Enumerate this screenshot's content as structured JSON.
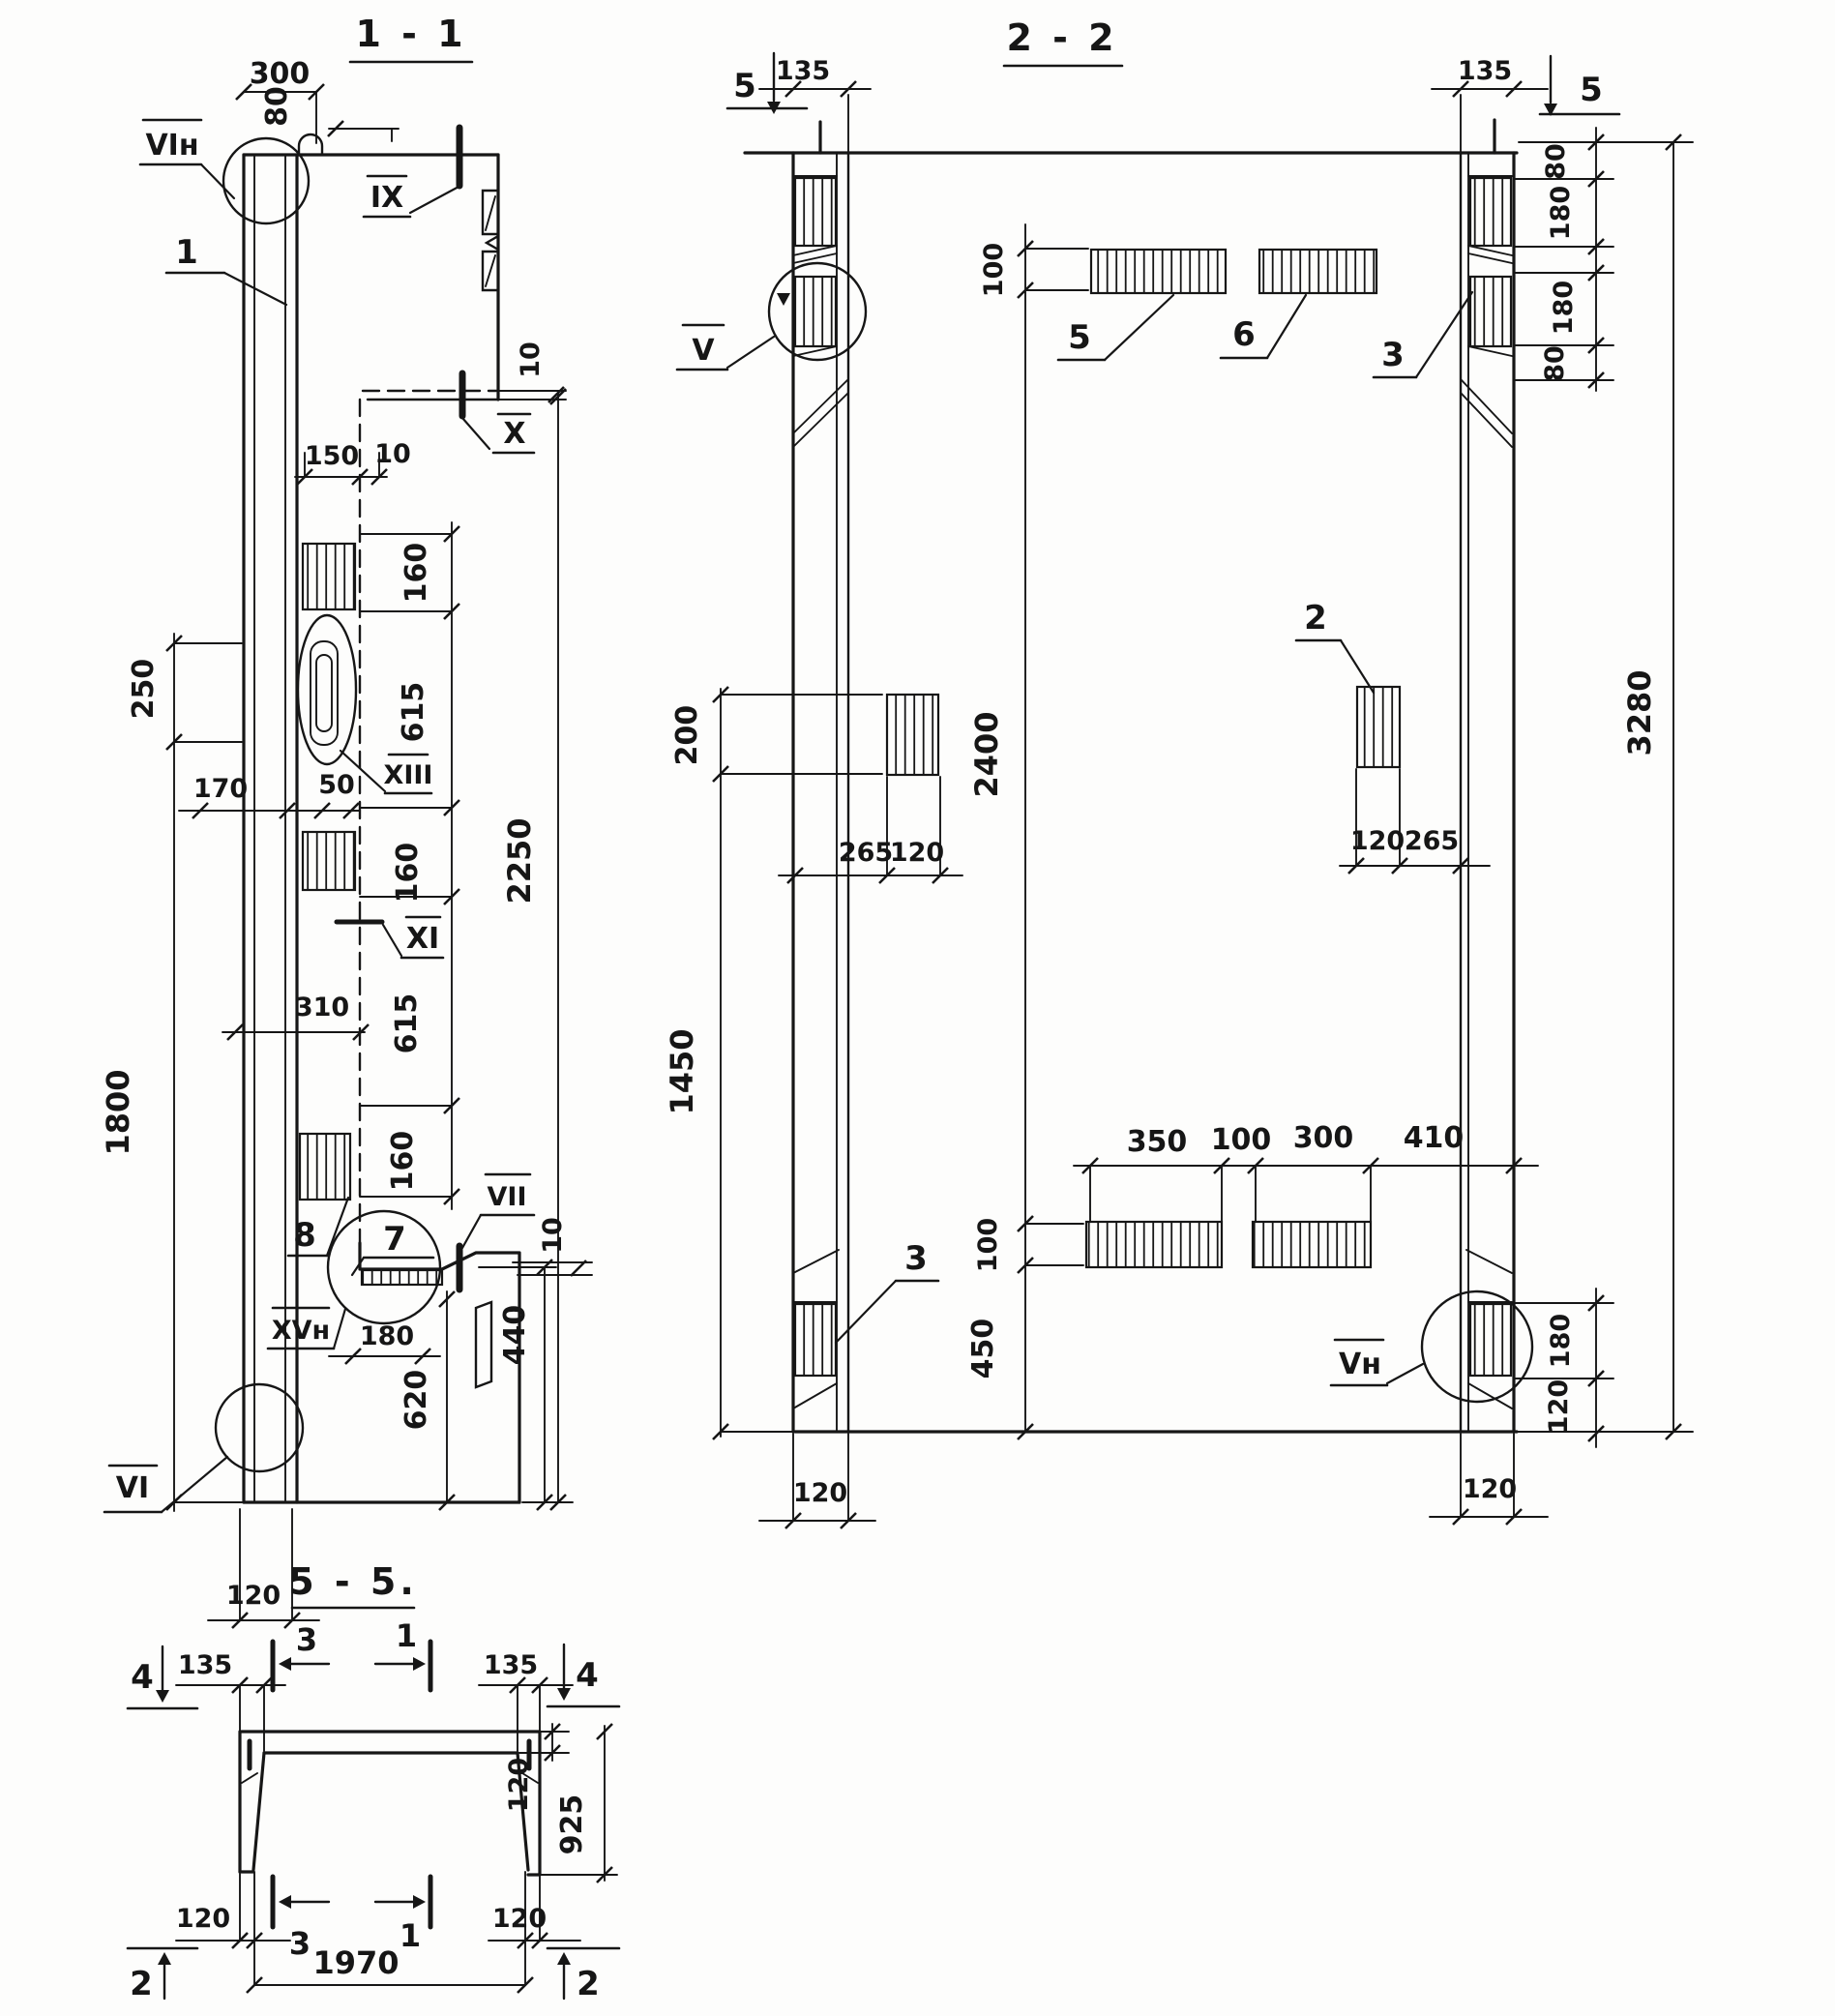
{
  "document": {
    "kind": "scanned structural engineering drawing",
    "subject": "Reinforced concrete ribbed panel - section views with reinforcement zones",
    "background": "#fdfdfc",
    "ink": "#161616",
    "views": [
      "1 - 1",
      "2 - 2",
      "5 - 5."
    ]
  },
  "sections": {
    "s1": {
      "title": "1 - 1",
      "texts": {
        "title": "1 - 1",
        "d300": "300",
        "d80": "80",
        "d10top": "10",
        "lbl_vi_n": "VIн",
        "ref1": "1",
        "lbl_ix": "IX",
        "lbl_x": "X",
        "d150": "150",
        "d10mid": "10",
        "d160a": "160",
        "d615a": "615",
        "d160b": "160",
        "d615b": "615",
        "d160c": "160",
        "d2250": "2250",
        "d250": "250",
        "d170": "170",
        "d50": "50",
        "d310": "310",
        "d1800": "1800",
        "lbl_xiii": "XIII",
        "lbl_xi": "XI",
        "ref8": "8",
        "ref7": "7",
        "lbl_vii": "VII",
        "d10bot": "10",
        "lbl_xv_n": "XVн",
        "d180": "180",
        "d620": "620",
        "d440": "440",
        "lbl_vi": "VI",
        "d120": "120"
      }
    },
    "s2": {
      "title": "2 - 2",
      "texts": {
        "title": "2 - 2",
        "mk5l": "5",
        "mk5r": "5",
        "d135l": "135",
        "d135r": "135",
        "d80a": "80",
        "d180a": "180",
        "d180b": "180",
        "d80b": "80",
        "d3280": "3280",
        "d100top": "100",
        "ref5": "5",
        "ref6": "6",
        "ref3r": "3",
        "lbl_v": "V",
        "ref2": "2",
        "d200": "200",
        "d2400": "2400",
        "d265l": "265",
        "d120l": "120",
        "d120r": "120",
        "d265r": "265",
        "d1450": "1450",
        "d350": "350",
        "d100mid": "100",
        "d300": "300",
        "d410": "410",
        "d100bot": "100",
        "d450": "450",
        "ref3l": "3",
        "lbl_v_n": "Vн",
        "d180r": "180",
        "d120rc": "120",
        "d120colL": "120",
        "d120colR": "120"
      }
    },
    "s5": {
      "title": "5 - 5.",
      "texts": {
        "title": "5 - 5.",
        "mk4l": "4",
        "mk4r": "4",
        "mk2l": "2",
        "mk2r": "2",
        "mk3top": "3",
        "mk1top": "1",
        "mk3bot": "3",
        "mk1bot": "1",
        "d135l": "135",
        "d135r": "135",
        "d120slab": "120",
        "d925": "925",
        "d120l": "120",
        "d120r": "120",
        "d1970": "1970"
      }
    }
  }
}
